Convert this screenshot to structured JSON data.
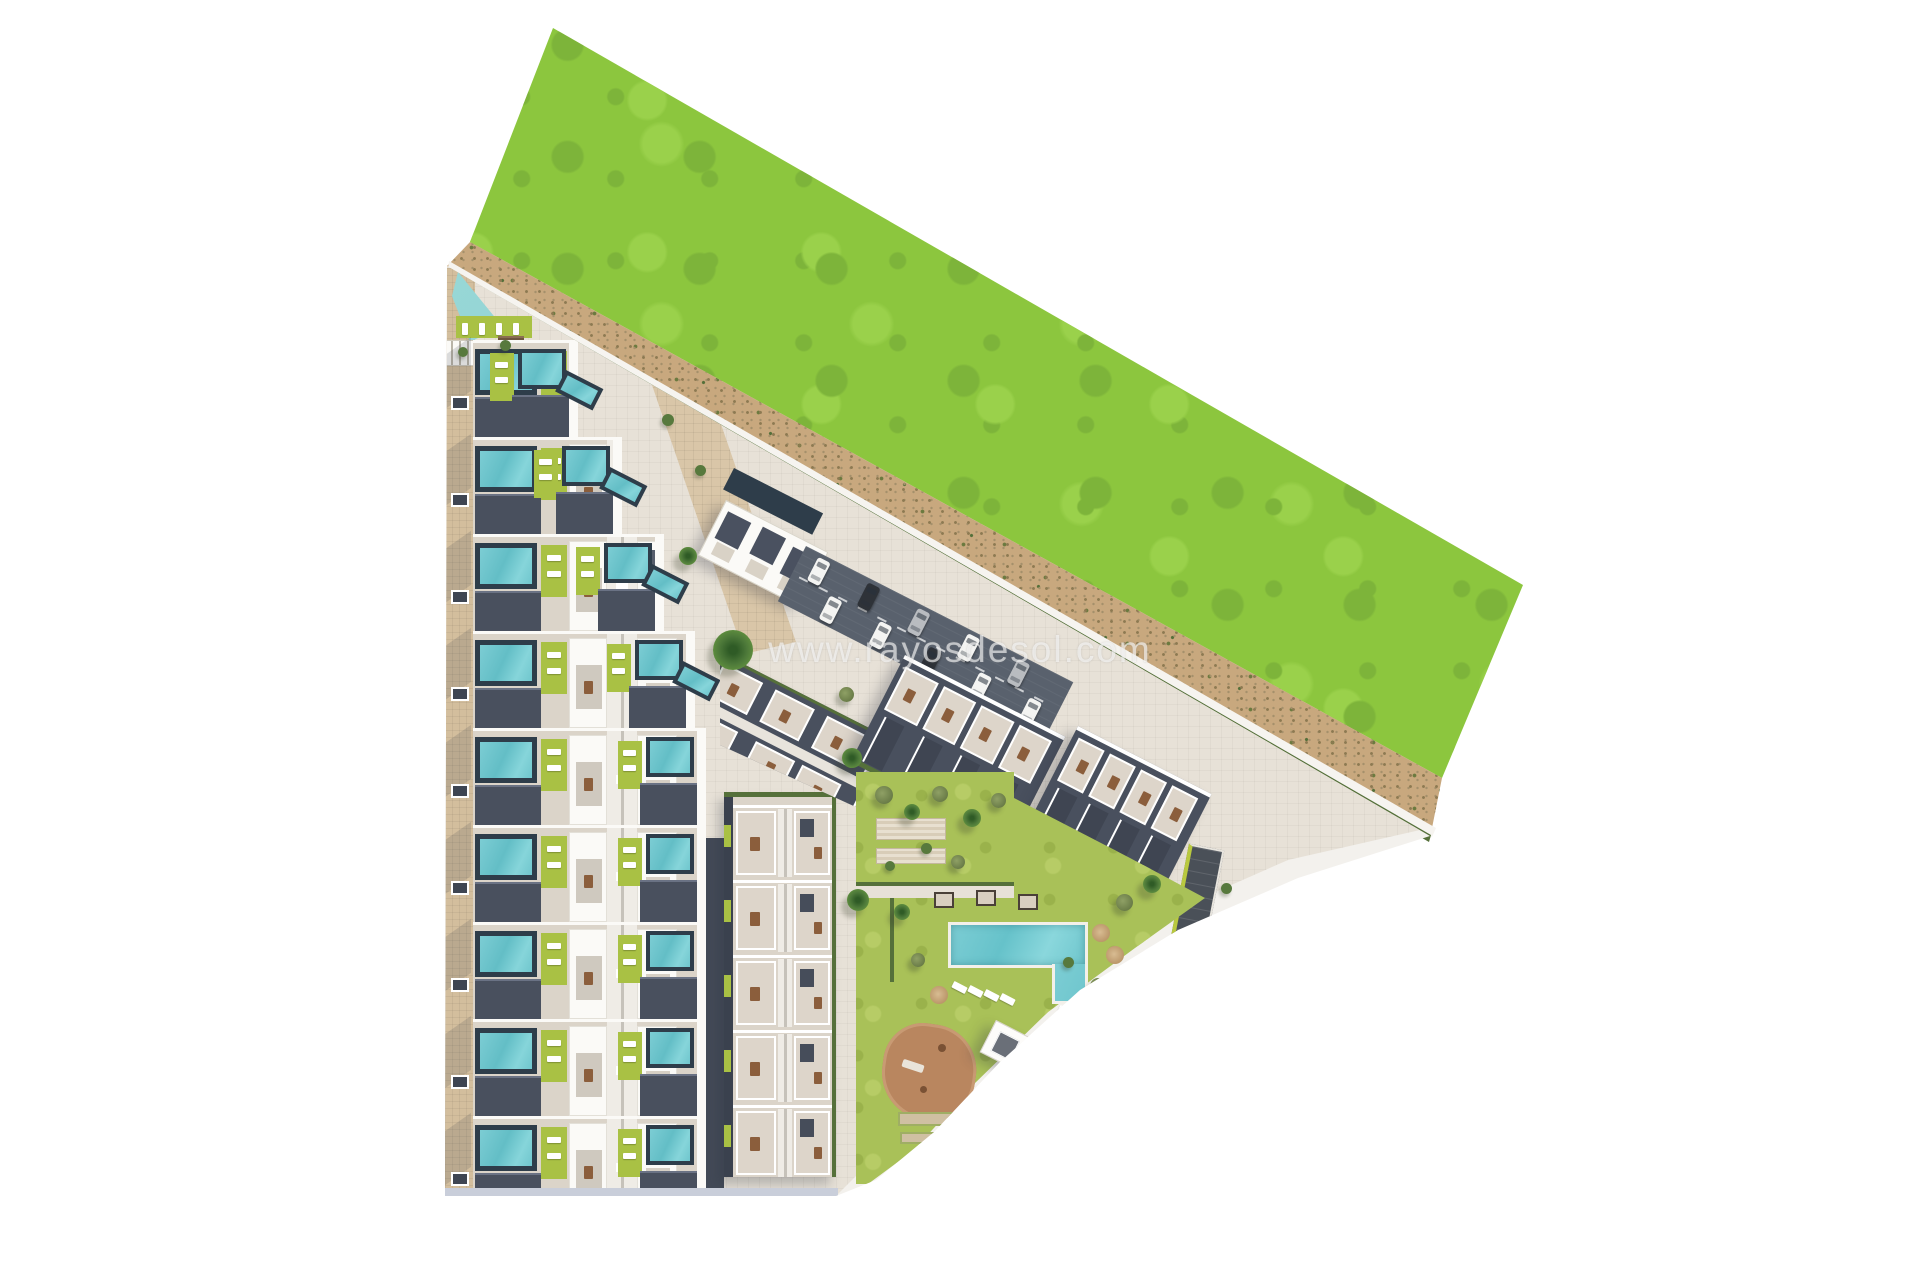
{
  "meta": {
    "description": "Aerial top-down 3D architectural render of a residential development site plan bordered by a large green field and a sandy rural road",
    "canvas": {
      "width": 1920,
      "height": 1280
    }
  },
  "watermark": {
    "text": "www.rayosdesol.com"
  },
  "palette": {
    "field_green": "#8cc63e",
    "field_green_dark": "#7db43a",
    "field_green_light": "#9ad14b",
    "road_sand": "#c8a87e",
    "road_speckle": "#8d7a52",
    "hedge_green": "#55703a",
    "pavement": "#e7e1d7",
    "path_tan": "#d3be9d",
    "promenade_tan": "#d9c6a8",
    "terrace_beige": "#dbd4c9",
    "roof_dark": "#49505e",
    "wall_white": "#fbfaf7",
    "pool_teal": "#5fb9bc",
    "pool_frame": "#2e3d4a",
    "garden_pool": "#72c8cf",
    "lime_green": "#a9c144",
    "lawn_green": "#a9c158",
    "asphalt": "#59616d",
    "driveway_dark": "#434a57",
    "playground_clay": "#b9865f",
    "court_sand": "#cfc0a2",
    "curb_strip": "#c9ceda",
    "furniture_brown": "#8b5e3c",
    "white_path": "#f3f1ed"
  },
  "inventory": {
    "townhouse_rows": 9,
    "pools_per_row": 2,
    "row_end_pools": 4,
    "middle_block_unit_rows": 5,
    "triangle_block_units": 6,
    "right_blocks": 2,
    "units_per_right_block": 4,
    "top_block_pools": 4,
    "parking_cars": [
      "white",
      "white",
      "dark",
      "white",
      "silver",
      "dark",
      "white",
      "white",
      "silver",
      "white"
    ],
    "trees": 28,
    "pool_cabanas": 3,
    "pergolas": 2,
    "sun_loungers": 8,
    "umbrellas": 3,
    "playgrounds": 1,
    "petanque_courts": 2
  }
}
